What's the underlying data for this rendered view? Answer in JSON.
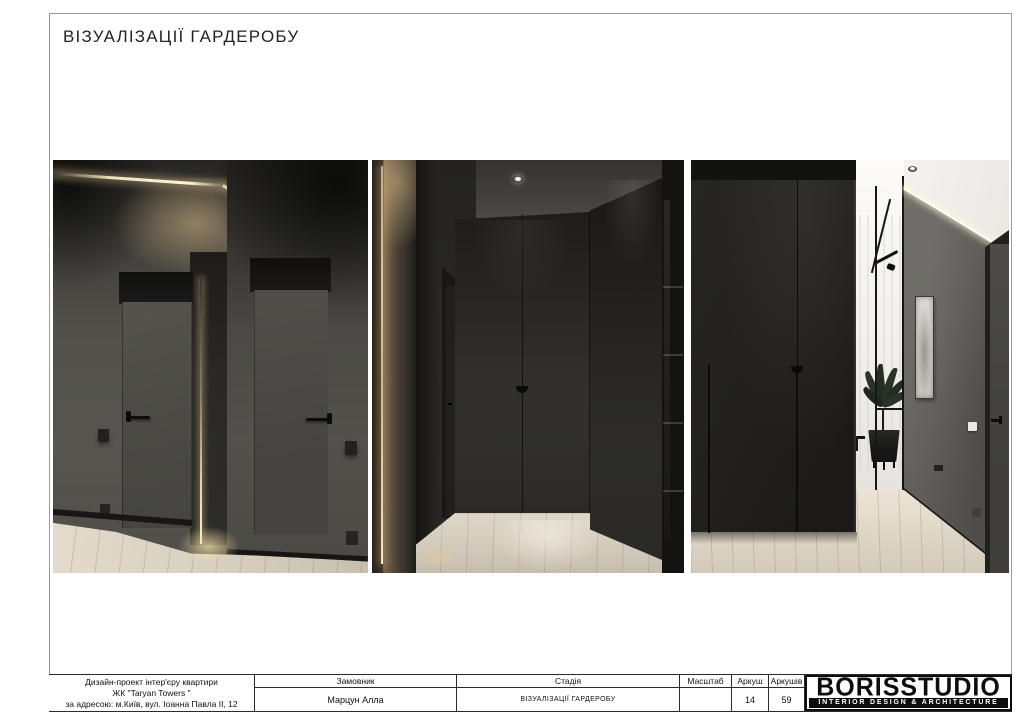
{
  "page": {
    "title": "ВІЗУАЛІЗАЦІЇ ГАРДЕРОБУ"
  },
  "title_block": {
    "project_lines": [
      "Дизайн-проект інтер'єру квартири",
      "ЖК \"Taryan Towers \"",
      "за адресою: м.Київ, вул. Іоанна Павла II, 12"
    ],
    "client_label": "Замовник",
    "client_value": "Марцун Алла",
    "stage_label": "Стадія",
    "stage_value": "ВІЗУАЛІЗАЦІЇ ГАРДЕРОБУ",
    "scale_label": "Масштаб",
    "scale_value": "",
    "sheet_label": "Аркуш",
    "sheet_value": "14",
    "sheets_label": "Аркушів",
    "sheets_value": "59"
  },
  "logo": {
    "name": "BORISSTUDIO",
    "tagline": "INTERIOR DESIGN & ARCHITECTURE"
  },
  "colors": {
    "paper": "#ffffff",
    "frame_border": "#9b9b9b",
    "table_line": "#2b2b2b",
    "logo_black": "#0d0d0d",
    "render_wall_gray": "#55544e",
    "render_charcoal": "#262523",
    "render_black_panel": "#1b1a18",
    "render_wood_floor": "#d9d1c2",
    "render_warm_light": "#e8cf9e",
    "render_ceiling_light": "#f1efec",
    "render_plant_green": "#2a332a"
  }
}
